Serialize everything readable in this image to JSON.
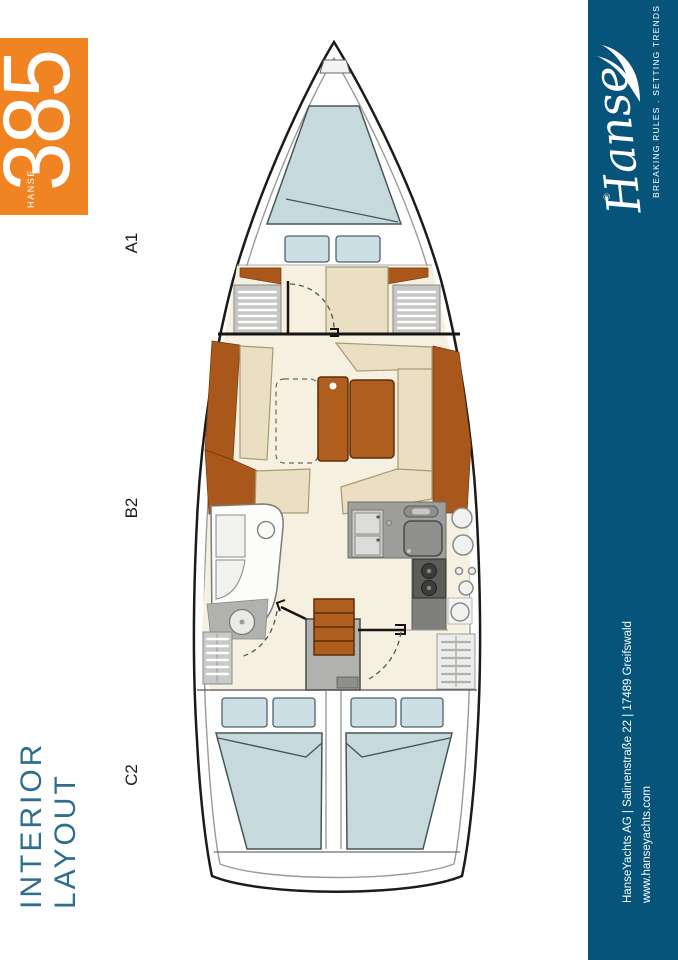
{
  "badge": {
    "brand": "HANSE",
    "model": "385"
  },
  "labels": {
    "forward": "A1",
    "middle": "B2",
    "aft": "C2"
  },
  "title": "INTERIOR LAYOUT",
  "sidebar": {
    "logo_script": "Hanse",
    "registered_mark": "®",
    "tagline": "BREAKING RULES . SETTING TRENDS",
    "address": "HanseYachts AG | Salinenstraße 22 | 17489 Greifswald",
    "website": "www.hanseyachts.com"
  },
  "colors": {
    "accent_orange": "#f08422",
    "sidebar_blue": "#06547a",
    "title_blue": "#2f6f8e",
    "floor_cream": "#f6f0e0",
    "upholstery_beige": "#eadfc2",
    "wood_brown": "#a9571b",
    "table_wood": "#b05e1e",
    "bed_blue": "#c6dade",
    "counter_gray": "#9e9e9c",
    "hull_line": "#1b1b1b"
  }
}
